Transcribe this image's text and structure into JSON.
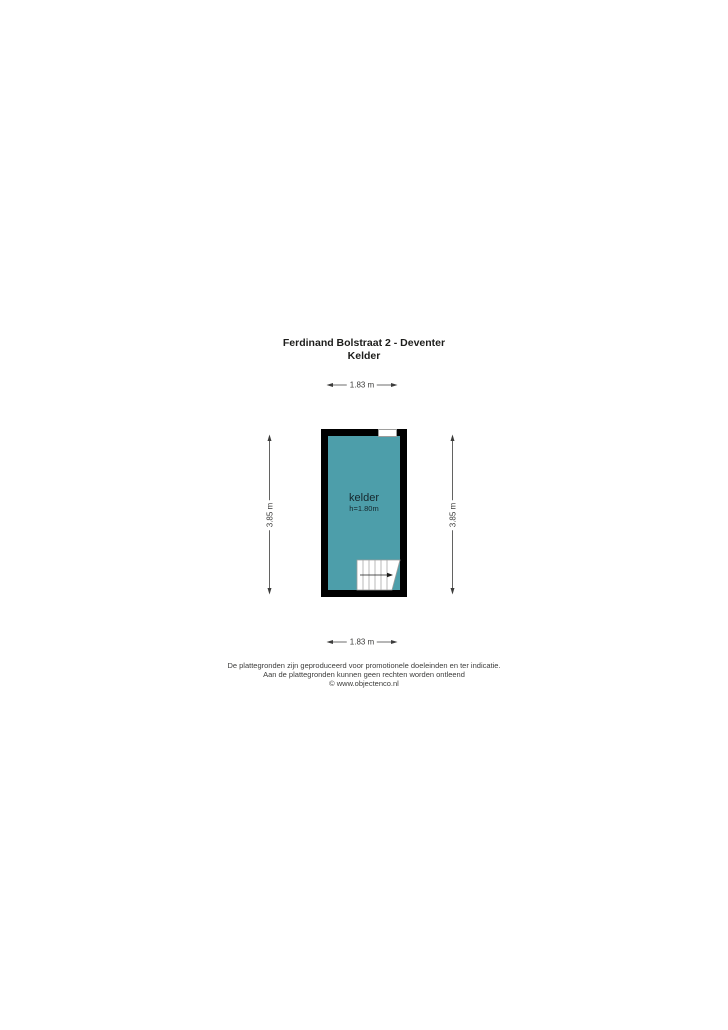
{
  "title": {
    "line1": "Ferdinand Bolstraat 2 - Deventer",
    "line2": "Kelder"
  },
  "floorplan": {
    "room": {
      "name": "kelder",
      "ceiling_height": "h=1.80m"
    },
    "colors": {
      "room_fill": "#4D9EAA",
      "wall": "#000000",
      "dimension_text": "#3C3C3B",
      "stair_outline": "#9D9D9C",
      "background": "#FFFFFF"
    }
  },
  "dimensions": {
    "top": "1.83 m",
    "bottom": "1.83 m",
    "left": "3.85 m",
    "right": "3.85 m"
  },
  "footer": {
    "line1": "De plattegronden zijn geproduceerd voor promotionele doeleinden en ter indicatie.",
    "line2": "Aan de plattegronden kunnen geen rechten worden ontleend",
    "line3": "© www.objectenco.nl"
  }
}
